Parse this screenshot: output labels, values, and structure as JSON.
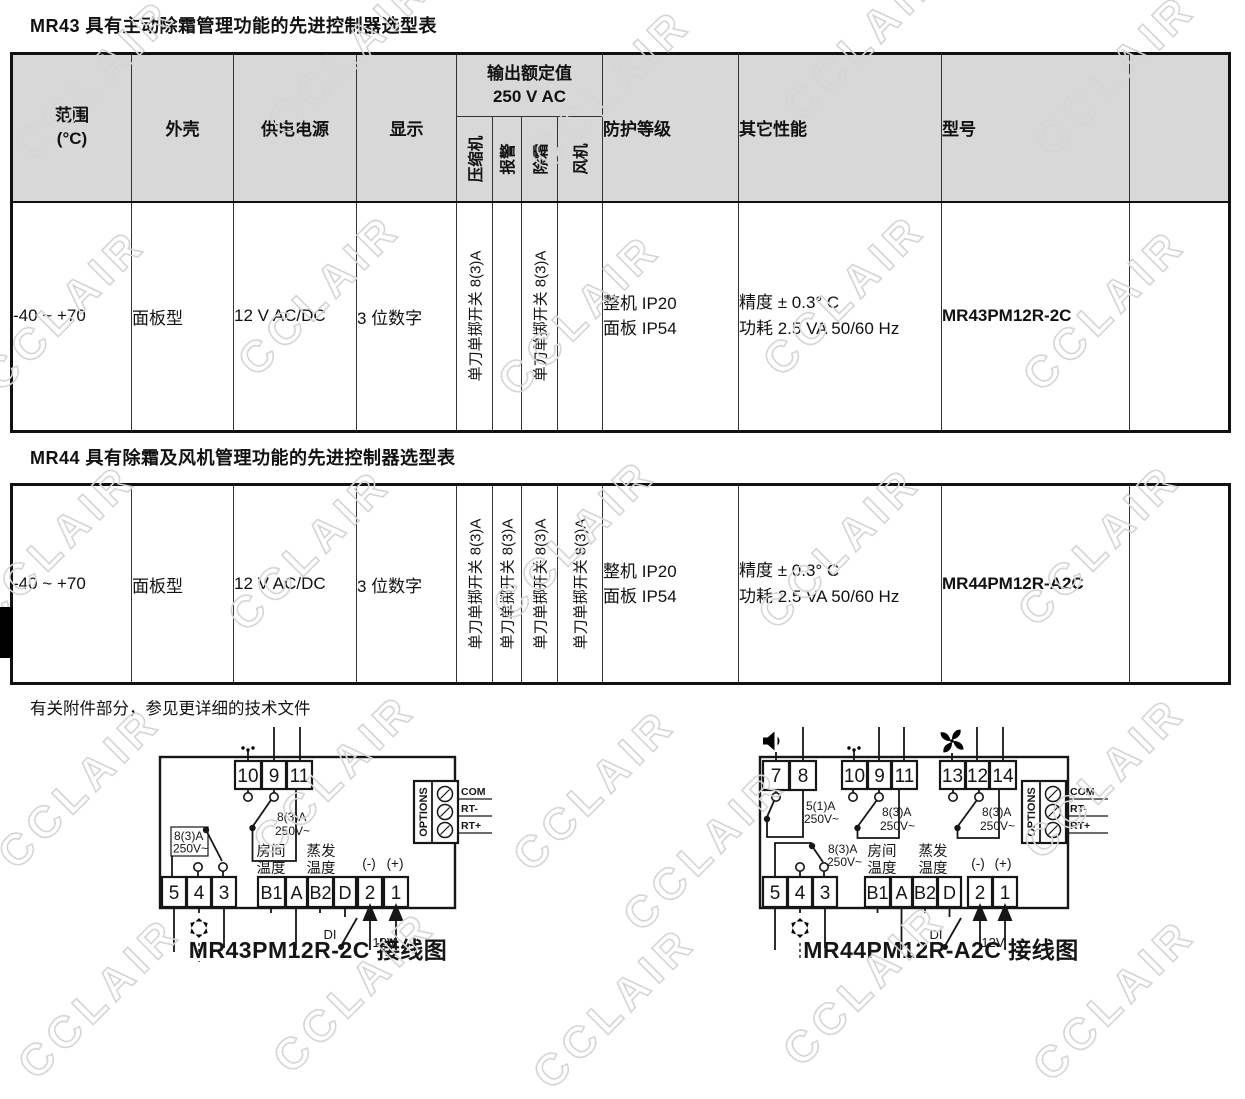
{
  "page": {
    "title_mr43": "MR43 具有主动除霜管理功能的先进控制器选型表",
    "title_mr44": "MR44 具有除霜及风机管理功能的先进控制器选型表",
    "note": "有关附件部分，参见更详细的技术文件",
    "watermark": "CCLAIR"
  },
  "table": {
    "header": {
      "range_1": "范围",
      "range_2": "(°C)",
      "housing": "外壳",
      "power": "供电电源",
      "display": "显示",
      "output_1": "输出额定值",
      "output_2": "250 V AC",
      "out_compressor": "压缩机",
      "out_alarm": "报警",
      "out_defrost": "除霜",
      "out_fan": "风机",
      "protection": "防护等级",
      "other": "其它性能",
      "model": "型号"
    },
    "spst": "单刀单掷开关 8(3)A",
    "mr43_row": {
      "range": "-40 ~ +70",
      "housing": "面板型",
      "power": "12 V AC/DC",
      "display": "3 位数字",
      "protection_1": "整机 IP20",
      "protection_2": "面板 IP54",
      "other_1": "精度 ± 0.3° C",
      "other_2": "功耗 2.5 VA 50/60 Hz",
      "model": "MR43PM12R-2C"
    },
    "mr44_row": {
      "range": "-40 ~ +70",
      "housing": "面板型",
      "power": "12 V AC/DC",
      "display": "3 位数字",
      "protection_1": "整机 IP20",
      "protection_2": "面板 IP54",
      "other_1": "精度 ± 0.3° C",
      "other_2": "功耗 2.5 VA 50/60 Hz",
      "model": "MR44PM12R-A2C"
    }
  },
  "diagram_mr43": {
    "caption": "MR43PM12R-2C 接线图",
    "t10": "10",
    "t9": "9",
    "t11": "11",
    "t5": "5",
    "t4": "4",
    "t3": "3",
    "tb1": "B1",
    "ta": "A",
    "tb2": "B2",
    "td": "D",
    "t2": "2",
    "t1": "1",
    "relay_defrost_1": "8(3)A",
    "relay_defrost_2": "250V~",
    "relay_comp_1": "8(3)A",
    "relay_comp_2": "250V~",
    "room_1": "房间",
    "room_2": "温度",
    "evap_1": "蒸发",
    "evap_2": "温度",
    "minus": "(-)",
    "plus": "(+)",
    "di": "DI",
    "v12": "12V",
    "options": "OPTIONS",
    "com": "COM",
    "rt_minus": "RT-",
    "rt_plus": "RT+"
  },
  "diagram_mr44": {
    "caption": "MR44PM12R-A2C 接线图",
    "t7": "7",
    "t8": "8",
    "t10": "10",
    "t9": "9",
    "t11": "11",
    "t13": "13",
    "t12": "12",
    "t14": "14",
    "t5": "5",
    "t4": "4",
    "t3": "3",
    "tb1": "B1",
    "ta": "A",
    "tb2": "B2",
    "td": "D",
    "t2": "2",
    "t1": "1",
    "relay_alarm_1": "5(1)A",
    "relay_alarm_2": "250V~",
    "relay_defrost_1": "8(3)A",
    "relay_defrost_2": "250V~",
    "relay_fan_1": "8(3)A",
    "relay_fan_2": "250V~",
    "relay_comp_1": "8(3)A",
    "relay_comp_2": "250V~",
    "room_1": "房间",
    "room_2": "温度",
    "evap_1": "蒸发",
    "evap_2": "温度",
    "minus": "(-)",
    "plus": "(+)",
    "di": "DI",
    "v12": "12V",
    "options": "OPTIONS",
    "com": "COM",
    "rt_minus": "RT-",
    "rt_plus": "RT+"
  }
}
